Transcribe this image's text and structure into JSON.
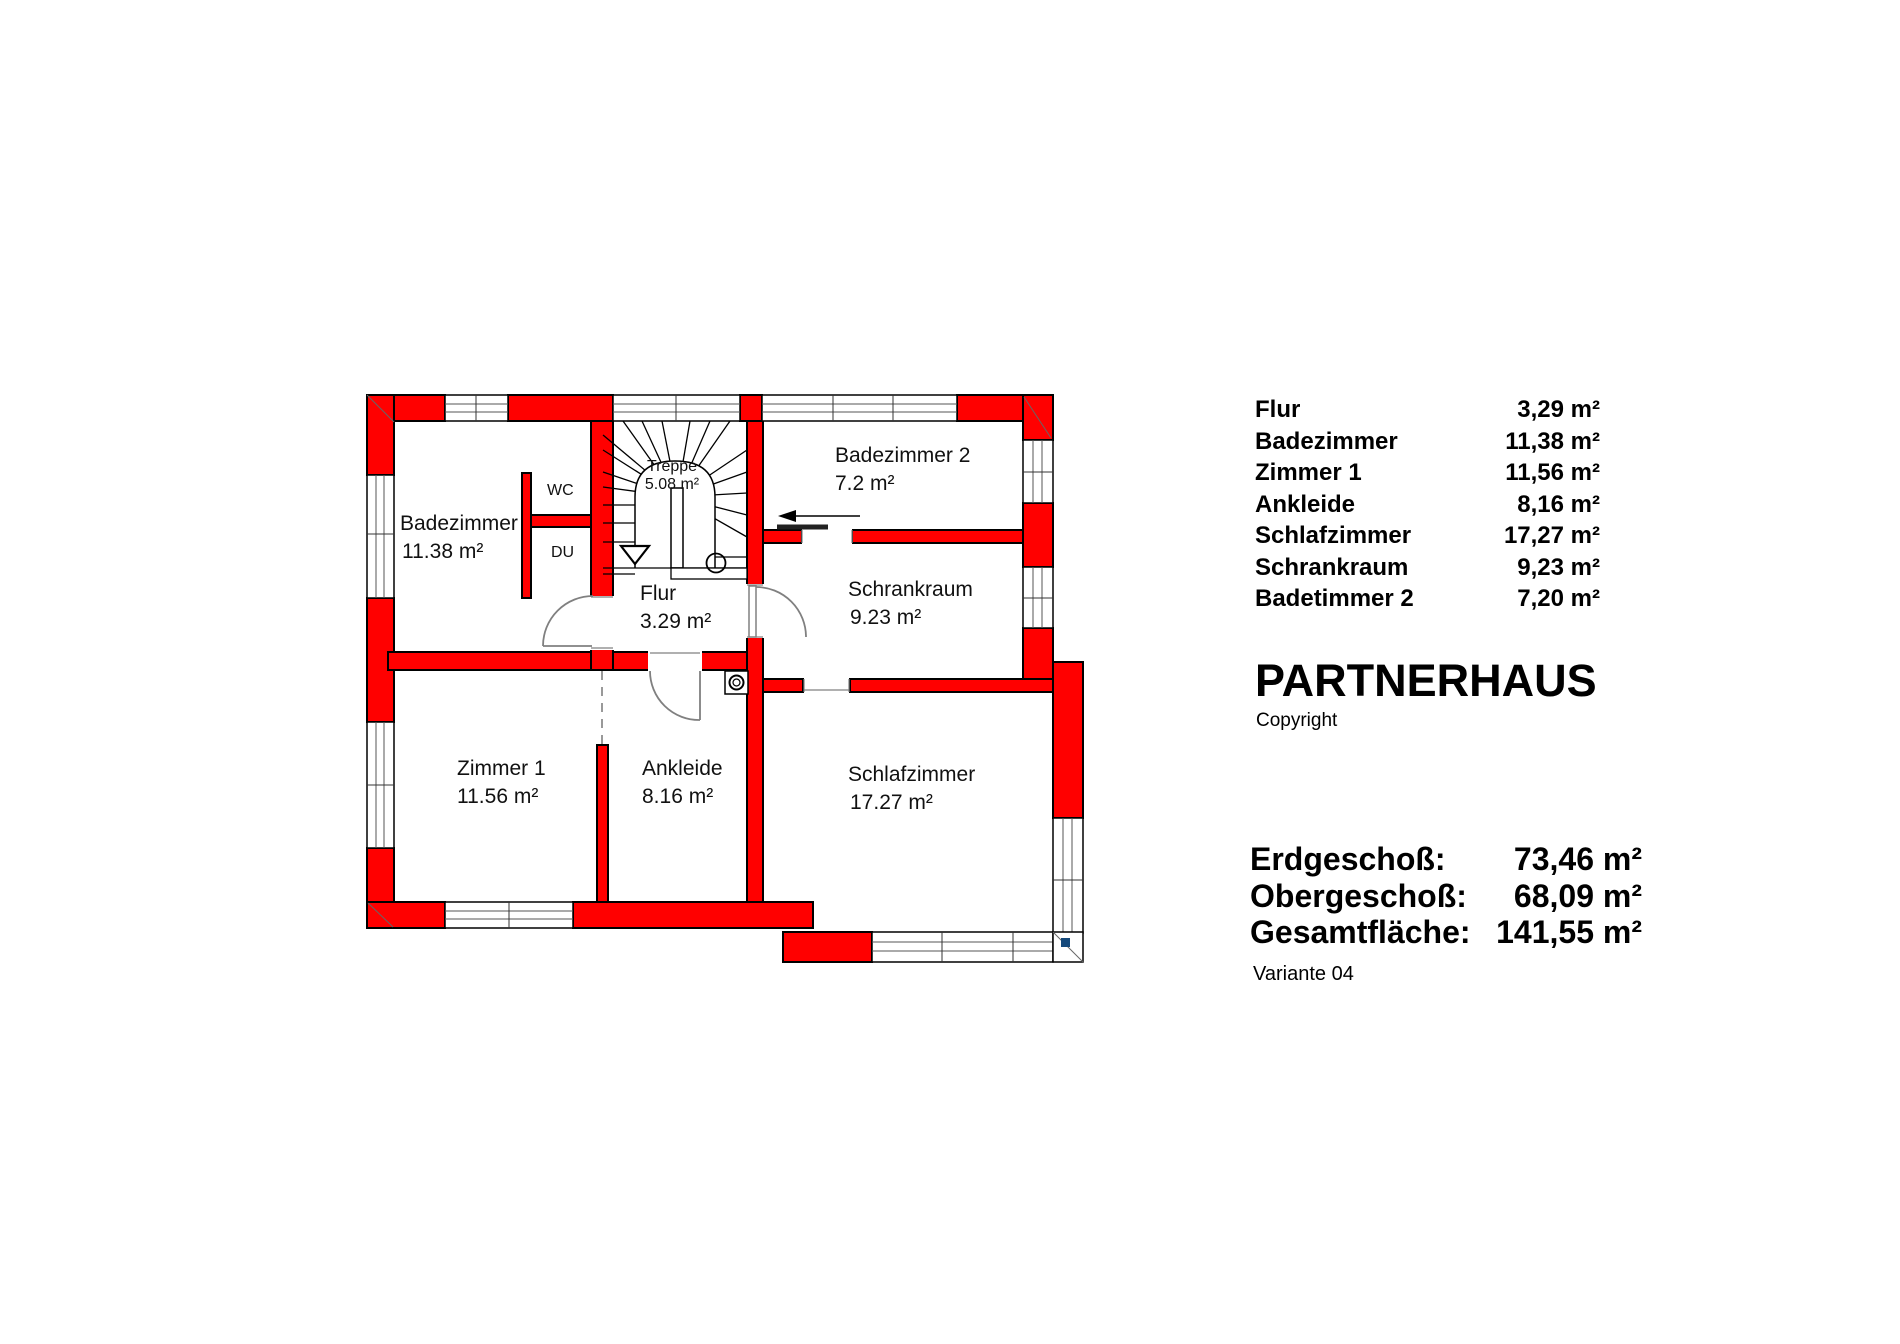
{
  "plan": {
    "rooms": {
      "badezimmer": {
        "label": "Badezimmer",
        "area": "11.38 m²"
      },
      "zimmer1": {
        "label": "Zimmer 1",
        "area": "11.56 m²"
      },
      "ankleide": {
        "label": "Ankleide",
        "area": "8.16 m²"
      },
      "schlafzimmer": {
        "label": "Schlafzimmer",
        "area": "17.27 m²"
      },
      "schrankraum": {
        "label": "Schrankraum",
        "area": "9.23 m²"
      },
      "badezimmer2": {
        "label": "Badezimmer 2",
        "area": "7.2 m²"
      },
      "flur": {
        "label": "Flur",
        "area": "3.29 m²"
      },
      "treppe": {
        "label": "Treppe",
        "area": "5.08 m²"
      }
    },
    "fixtures": {
      "wc": "WC",
      "du": "DU"
    },
    "colors": {
      "wall": "#ff0000",
      "outline": "#000000",
      "door_swing": "#808080",
      "corner_marker": "#15497b"
    }
  },
  "sidebar": {
    "room_table": [
      {
        "label": "Flur",
        "value": "3,29 m²"
      },
      {
        "label": "Badezimmer",
        "value": "11,38 m²"
      },
      {
        "label": "Zimmer 1",
        "value": "11,56 m²"
      },
      {
        "label": "Ankleide",
        "value": "8,16 m²"
      },
      {
        "label": "Schlafzimmer",
        "value": "17,27 m²"
      },
      {
        "label": "Schrankraum",
        "value": "9,23 m²"
      },
      {
        "label": "Badetimmer 2",
        "value": "7,20 m²"
      }
    ],
    "title": "PARTNERHAUS",
    "copyright": "Copyright",
    "summary": [
      {
        "label": "Erdgeschoß:",
        "value": "73,46 m²"
      },
      {
        "label": "Obergeschoß:",
        "value": "68,09 m²"
      },
      {
        "label": "Gesamtfläche:",
        "value": "141,55 m²"
      }
    ],
    "variant": "Variante 04"
  }
}
